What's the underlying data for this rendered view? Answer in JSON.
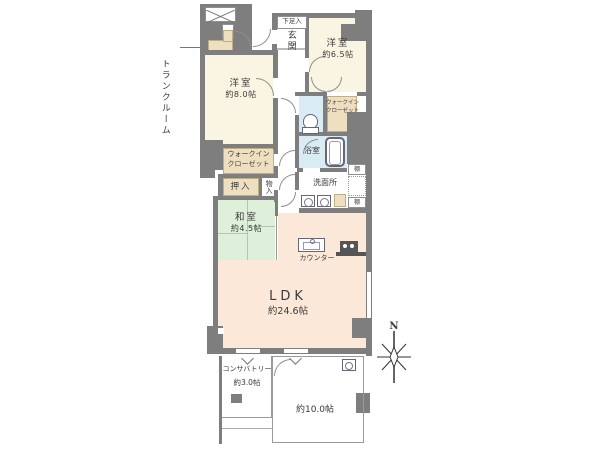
{
  "floorplan": {
    "compass": {
      "north_label": "N"
    },
    "labels": {
      "trunk_room": "トランクルーム",
      "shoe_storage": "下足入",
      "entrance": "玄関",
      "bedroom8_name": "洋室",
      "bedroom8_size": "約8.0帖",
      "bedroom65_name": "洋室",
      "bedroom65_size": "約6.5帖",
      "wic_upper_line1": "ウォークイン",
      "wic_upper_line2": "クローゼット",
      "wic_left_line1": "ウォークイン",
      "wic_left_line2": "クローゼット",
      "bath": "浴室",
      "washroom": "洗面所",
      "shelf_top": "棚",
      "shelf_bottom": "棚",
      "oshiire": "押入",
      "monoire": "物入",
      "washitsu_name": "和室",
      "washitsu_size": "約4.5帖",
      "ldk_name": "LDK",
      "ldk_size": "約24.6帖",
      "counter": "カウンター",
      "conservatory_name": "コンサバトリー",
      "conservatory_size": "約3.0帖",
      "terrace_size": "約10.0帖"
    },
    "colors": {
      "wall": "#7e7e7e",
      "cream": "#faf4e2",
      "peach": "#fce8d8",
      "green": "#def0da",
      "blue": "#d9ecf4",
      "beige": "#eedfc0"
    }
  }
}
